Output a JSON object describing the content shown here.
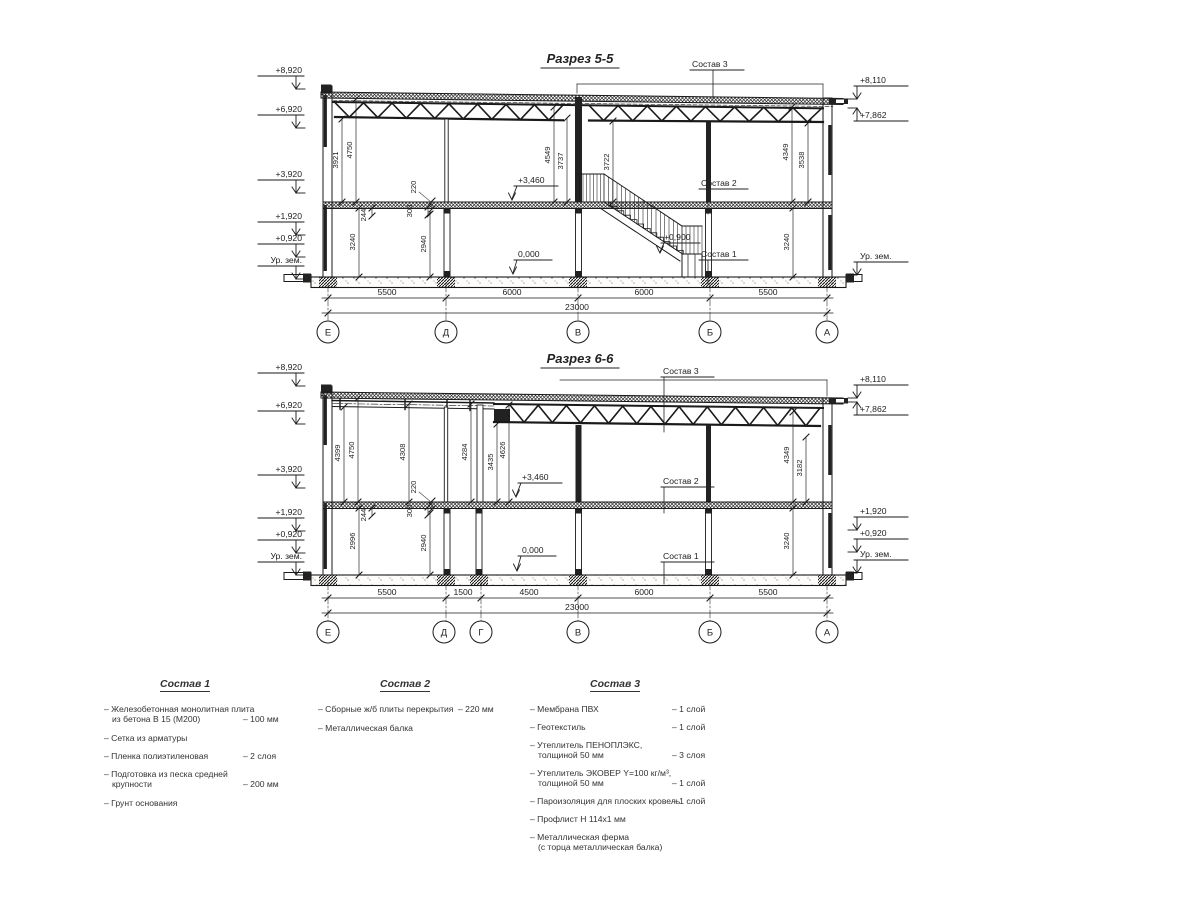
{
  "s55": {
    "title": "Разрез 5-5",
    "elev_left": [
      "+8,920",
      "+6,920",
      "+3,920",
      "+1,920",
      "+0,920",
      "Ур. зем."
    ],
    "elev_right": [
      "+8,110",
      "+7,862",
      "Ур. зем."
    ],
    "vdims": [
      "3921",
      "4750",
      "4549",
      "3737",
      "3722",
      "4349",
      "3538",
      "3240",
      "2940",
      "3240",
      "220",
      "244",
      "300"
    ],
    "marks": [
      "+3,460",
      "0,000",
      "+0,900"
    ],
    "callouts": [
      "Состав 3",
      "Состав 2",
      "Состав 1"
    ],
    "bottom_dims": [
      "5500",
      "6000",
      "6000",
      "5500"
    ],
    "total_dim": "23000",
    "axes": [
      "Е",
      "Д",
      "В",
      "Б",
      "А"
    ]
  },
  "s66": {
    "title": "Разрез 6-6",
    "elev_left": [
      "+8,920",
      "+6,920",
      "+3,920",
      "+1,920",
      "+0,920",
      "Ур. зем."
    ],
    "elev_right": [
      "+8,110",
      "+7,862",
      "+1,920",
      "+0,920",
      "Ур. зем."
    ],
    "vdims": [
      "4399",
      "4750",
      "4308",
      "4284",
      "3435",
      "4626",
      "4349",
      "3182",
      "2996",
      "2940",
      "3240",
      "220",
      "244",
      "300"
    ],
    "marks": [
      "+3,460",
      "0,000"
    ],
    "callouts": [
      "Состав 3",
      "Состав 2",
      "Состав 1"
    ],
    "bottom_dims": [
      "5500",
      "1500",
      "4500",
      "6000",
      "5500"
    ],
    "total_dim": "23000",
    "axes": [
      "Е",
      "Д",
      "Г",
      "В",
      "Б",
      "А"
    ]
  },
  "legend": {
    "c1": {
      "title": "Состав 1",
      "r0t": "– Железобетонная  монолитная плита",
      "r0t2": "из бетона В 15 (М200)",
      "r0v": "– 100 мм",
      "r1t": "– Сетка из арматуры",
      "r2t": "– Пленка полиэтиленовая",
      "r2v": "– 2 слоя",
      "r3t": "– Подготовка из песка средней",
      "r3t2": "крупности",
      "r3v": "– 200 мм",
      "r4t": "– Грунт основания"
    },
    "c2": {
      "title": "Состав 2",
      "r0t": "– Сборные ж/б плиты перекрытия",
      "r0v": "– 220 мм",
      "r1t": "– Металлическая балка"
    },
    "c3": {
      "title": "Состав 3",
      "r0t": "– Мембрана ПВХ",
      "r0v": "– 1 слой",
      "r1t": "– Геотекстиль",
      "r1v": "– 1 слой",
      "r2t": "– Утеплитель ПЕНОПЛЭКС,",
      "r2t2": "толщиной 50 мм",
      "r2v": "– 3 слоя",
      "r3t": "– Утеплитель ЭКОВЕР Y=100 кг/м³,",
      "r3t2": "толщиной 50 мм",
      "r3v": "– 1 слой",
      "r4t": "– Пароизоляция для плоских кровель",
      "r4v": "– 1 слой",
      "r5t": "– Профлист Н 114х1 мм",
      "r6t": "– Металлическая ферма",
      "r6t2": "(с торца металлическая балка)"
    }
  }
}
